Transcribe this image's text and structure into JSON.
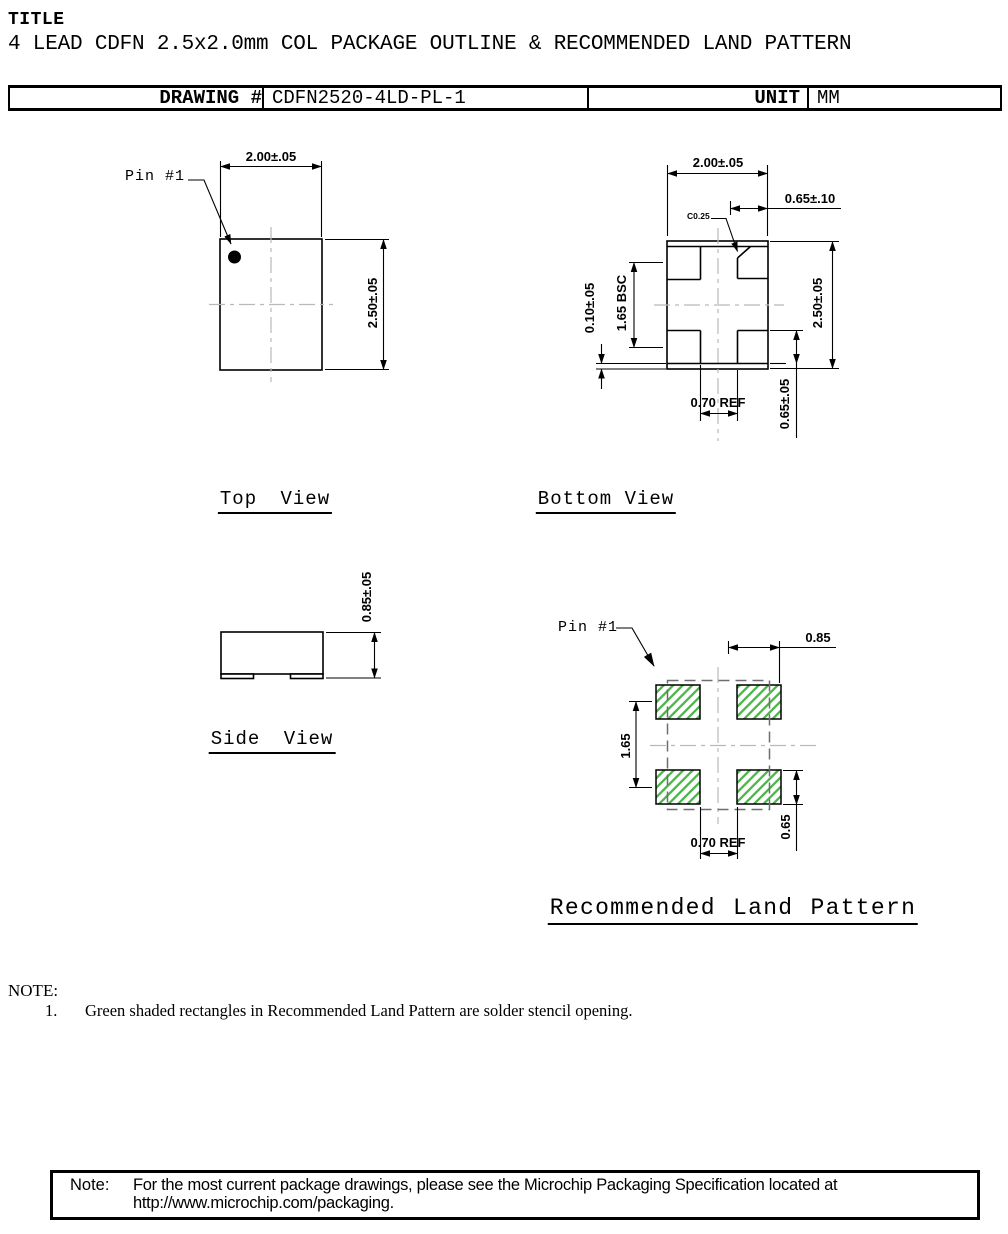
{
  "header": {
    "title_label": "TITLE",
    "subtitle": "4 LEAD CDFN 2.5x2.0mm COL PACKAGE OUTLINE & RECOMMENDED LAND PATTERN"
  },
  "info_table": {
    "drawing_label": "DRAWING #",
    "drawing_number": "CDFN2520-4LD-PL-1",
    "unit_label": "UNIT",
    "unit_value": "MM"
  },
  "top_view": {
    "caption": "Top View",
    "pin1_label": "Pin #1",
    "dim_body_width": "2.00±.05",
    "dim_body_height": "2.50±.05"
  },
  "bottom_view": {
    "caption": "Bottom View",
    "dim_body_width": "2.00±.05",
    "dim_terminal_width": "0.65±.10",
    "chamfer_label": "C0.25",
    "dim_terminal_pitch": "1.65 BSC",
    "dim_edge_gap": "0.10±.05",
    "dim_body_height": "2.50±.05",
    "dim_terminal_length": "0.65±.05",
    "dim_center_gap": "0.70 REF"
  },
  "side_view": {
    "caption": "Side View",
    "dim_body_thickness": "0.85±.05"
  },
  "land_pattern": {
    "caption": "Recommended Land Pattern",
    "pin1_label": "Pin #1",
    "dim_pad_width": "0.85",
    "dim_pad_pitch": "1.65",
    "dim_center_gap": "0.70 REF",
    "dim_pad_length": "0.65"
  },
  "notes": {
    "heading": "NOTE:",
    "item_number": "1.",
    "item_text": "Green shaded rectangles in Recommended Land Pattern are solder stencil opening."
  },
  "footer_note": {
    "label": "Note:",
    "line1": "For the most current package drawings, please see the Microchip Packaging Specification located at",
    "line2": "http://www.microchip.com/packaging."
  },
  "colors": {
    "hatch_green": "#4cb749",
    "centerline_gray": "#b9b9b9",
    "package_outline_dash_gray": "#6e6e6e",
    "line_black": "#000000"
  }
}
